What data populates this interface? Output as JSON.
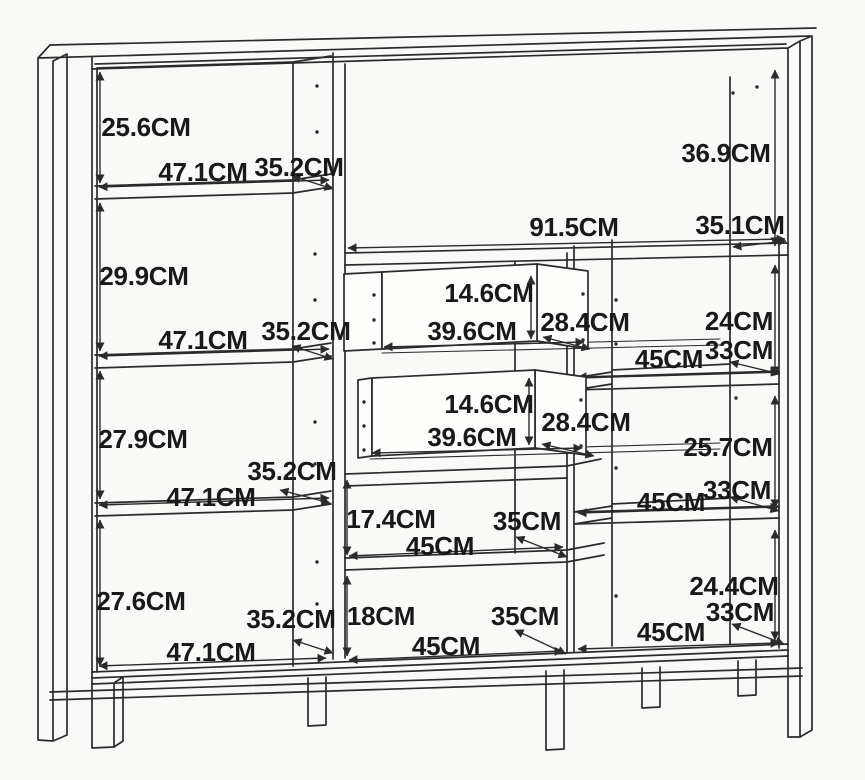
{
  "canvas": {
    "width": 865,
    "height": 780,
    "background_color": "#f9f9f8",
    "line_color": "#2b2b2b",
    "label_color": "#191919"
  },
  "unit": "CM",
  "labels": [
    {
      "id": "left-row1-height",
      "text": "25.6CM"
    },
    {
      "id": "left-row1-width",
      "text": "47.1CM"
    },
    {
      "id": "left-row1-depth",
      "text": "35.2CM"
    },
    {
      "id": "top-open-height",
      "text": "36.9CM"
    },
    {
      "id": "top-open-width",
      "text": "91.5CM"
    },
    {
      "id": "top-open-depth",
      "text": "35.1CM"
    },
    {
      "id": "left-row2-height",
      "text": "29.9CM"
    },
    {
      "id": "left-row2-width",
      "text": "47.1CM"
    },
    {
      "id": "left-row2-depth",
      "text": "35.2CM"
    },
    {
      "id": "drawer1-height",
      "text": "14.6CM"
    },
    {
      "id": "drawer1-width",
      "text": "39.6CM"
    },
    {
      "id": "drawer1-depth",
      "text": "28.4CM"
    },
    {
      "id": "right-row1-height",
      "text": "24CM"
    },
    {
      "id": "right-row1-width",
      "text": "45CM"
    },
    {
      "id": "right-row1-depth",
      "text": "33CM"
    },
    {
      "id": "drawer2-height",
      "text": "14.6CM"
    },
    {
      "id": "drawer2-width",
      "text": "39.6CM"
    },
    {
      "id": "drawer2-depth",
      "text": "28.4CM"
    },
    {
      "id": "right-row2-height",
      "text": "25.7CM"
    },
    {
      "id": "right-row2-depth",
      "text": "33CM"
    },
    {
      "id": "right-row2-width",
      "text": "45CM"
    },
    {
      "id": "left-row3-height",
      "text": "27.9CM"
    },
    {
      "id": "left-row3-depth",
      "text": "35.2CM"
    },
    {
      "id": "left-row3-width",
      "text": "47.1CM"
    },
    {
      "id": "mid-row1-height",
      "text": "17.4CM"
    },
    {
      "id": "mid-row1-depth",
      "text": "35CM"
    },
    {
      "id": "mid-row1-width",
      "text": "45CM"
    },
    {
      "id": "left-row4-height",
      "text": "27.6CM"
    },
    {
      "id": "left-row4-depth",
      "text": "35.2CM"
    },
    {
      "id": "mid-row2-height",
      "text": "18CM"
    },
    {
      "id": "mid-row2-depth",
      "text": "35CM"
    },
    {
      "id": "mid-row2-width",
      "text": "45CM"
    },
    {
      "id": "left-row4-width",
      "text": "47.1CM"
    },
    {
      "id": "right-row3-height",
      "text": "24.4CM"
    },
    {
      "id": "right-row3-depth",
      "text": "33CM"
    },
    {
      "id": "right-row3-width",
      "text": "45CM"
    }
  ]
}
